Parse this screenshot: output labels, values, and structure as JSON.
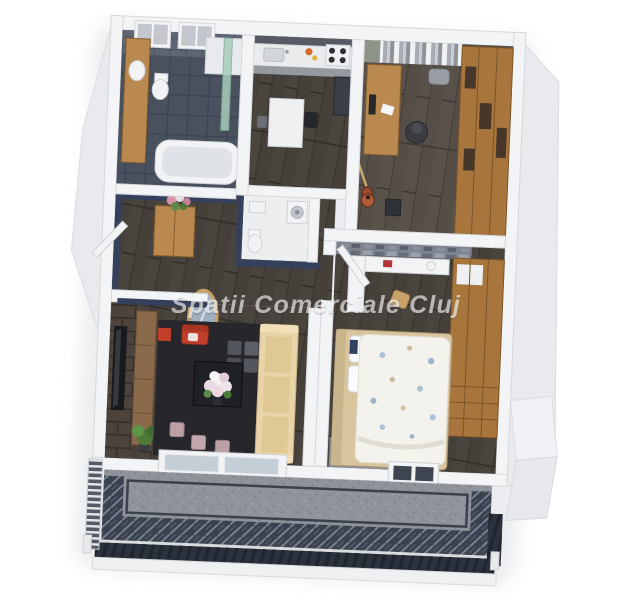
{
  "watermark": {
    "text": "Spatii Comerciale Cluj"
  },
  "palette": {
    "background": "#ffffff",
    "outer_wall_white": "#f3f4f6",
    "outer_wall_face": "#e9eaee",
    "navy_accent_wall": "#35415c",
    "wood_floor_dark": "#46403b",
    "wood_floor_office": "#554e47",
    "bath_tile": "#49505e",
    "tile_wall": "#5e6573",
    "brick_wall": "#4b433c",
    "stone_mosaic": "#7c828e",
    "oak_furniture": "#b9894f",
    "wardrobe_oak": "#a8763d",
    "sofa_cream": "#e8d4a6",
    "armchair_red": "#c2402a",
    "duvet_white": "#f4f2ec",
    "duvet_floral_blue": "#adc0d4",
    "shower_glass_green": "#a9cdbb",
    "balcony_floor_gray": "#90939a",
    "balcony_border_dark": "#3b424f",
    "railing_dark": "#2b313d",
    "watermark_white": "#ffffff"
  }
}
